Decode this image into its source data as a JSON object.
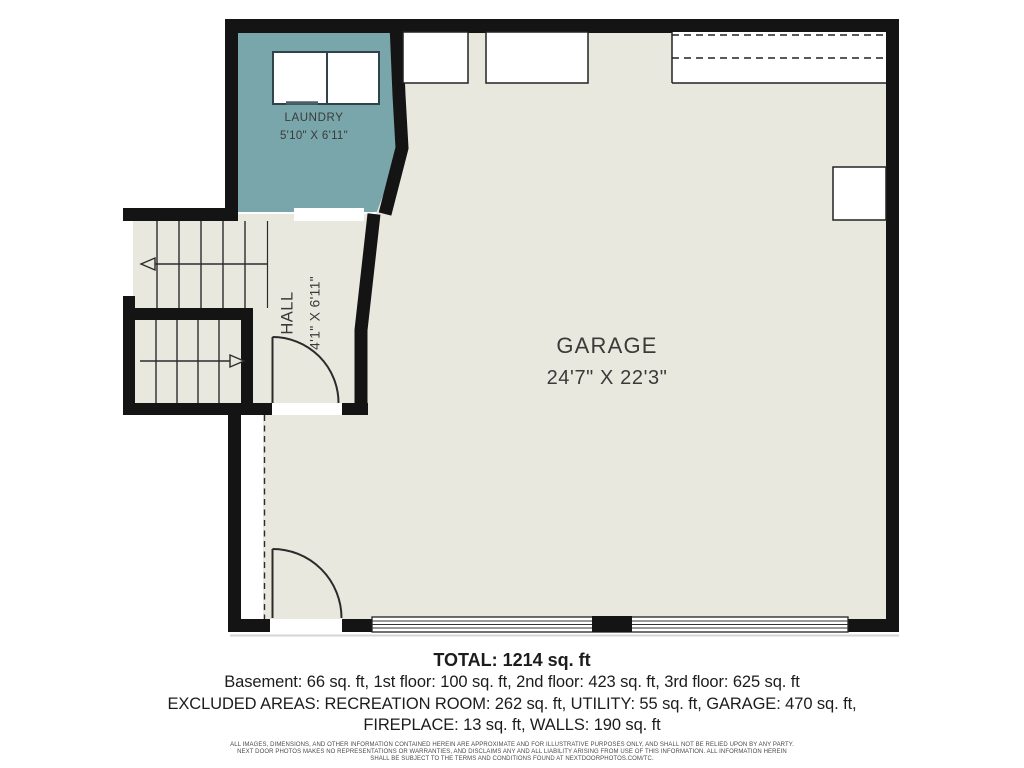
{
  "floor_plan": {
    "rooms": [
      {
        "id": "laundry",
        "label": "LAUNDRY",
        "dimensions": "5'10\" X 6'11\""
      },
      {
        "id": "hall",
        "label": "HALL",
        "dimensions": "4'1\" X 6'11\""
      },
      {
        "id": "garage",
        "label": "GARAGE",
        "dimensions": "24'7\" X 22'3\""
      }
    ],
    "colors": {
      "wall": "#141414",
      "laundry_fill": "#78a6ab",
      "floor_fill": "#e9e8df",
      "page": "#ffffff"
    }
  },
  "summary": {
    "total": "TOTAL: 1214 sq. ft",
    "floor_breakdown": "Basement: 66 sq. ft, 1st floor: 100 sq. ft, 2nd floor: 423 sq. ft, 3rd floor: 625 sq. ft",
    "excluded_line1": "EXCLUDED AREAS: RECREATION ROOM: 262 sq. ft, UTILITY: 55 sq. ft, GARAGE: 470 sq. ft,",
    "excluded_line2": "FIREPLACE: 13 sq. ft, WALLS: 190 sq. ft"
  },
  "disclaimer": {
    "line1": "ALL IMAGES, DIMENSIONS, AND OTHER INFORMATION CONTAINED HEREIN ARE APPROXIMATE AND FOR ILLUSTRATIVE PURPOSES ONLY, AND SHALL NOT BE RELIED UPON BY ANY PARTY.",
    "line2": "NEXT DOOR PHOTOS MAKES NO REPRESENTATIONS OR WARRANTIES, AND DISCLAIMS ANY AND ALL LIABILITY ARISING FROM USE OF THIS INFORMATION. ALL INFORMATION HEREIN",
    "line3": "SHALL BE SUBJECT TO THE TERMS AND CONDITIONS FOUND AT NEXTDOORPHOTOS.COM/TC."
  }
}
